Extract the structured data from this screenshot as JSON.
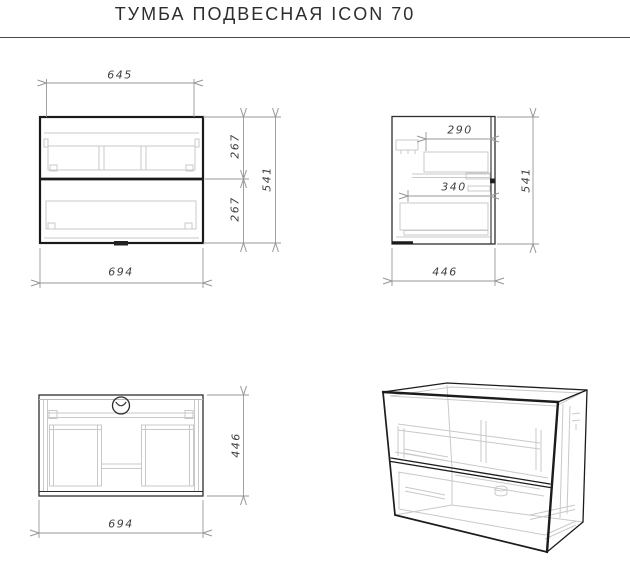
{
  "title": "ТУМБА ПОДВЕСНАЯ ICON 70",
  "front_view": {
    "inner_width": "645",
    "outer_width": "694",
    "upper_drawer_height": "267",
    "lower_drawer_height": "267",
    "total_height": "541"
  },
  "side_view": {
    "upper_drawer_depth": "290",
    "lower_drawer_depth": "340",
    "depth": "446",
    "total_height": "541"
  },
  "top_view": {
    "width": "694",
    "depth": "446"
  },
  "colors": {
    "outline_strong": "#1a1a1a",
    "outline_medium": "#2e2e2e",
    "detail_light": "#c9c9c9",
    "dimension_line": "#979797",
    "dimension_text": "#3f3f3f",
    "title_text": "#2d2d2d",
    "divider_rule": "#4a4a4a"
  }
}
